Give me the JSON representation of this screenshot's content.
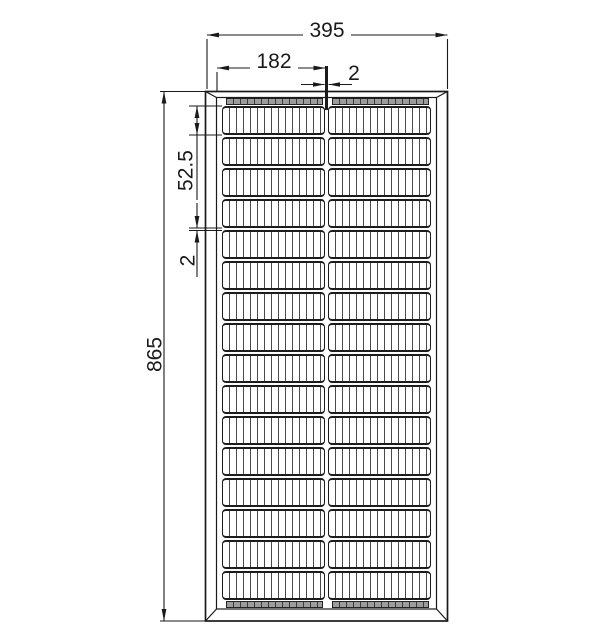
{
  "drawing": {
    "type": "technical-dimension-drawing",
    "subject": "solar panel front view with cell grid and frame",
    "dimensions": {
      "overall_width": "395",
      "column_width": "182",
      "center_gap": "2",
      "overall_height": "865",
      "cell_height": "52.5",
      "row_gap": "2"
    },
    "panel": {
      "rows": 16,
      "columns": 2
    },
    "colors": {
      "line": "#1a1a1a",
      "busbar": "#9c9c9c",
      "cell_finger": "#4a4a4a",
      "background": "#ffffff"
    }
  }
}
